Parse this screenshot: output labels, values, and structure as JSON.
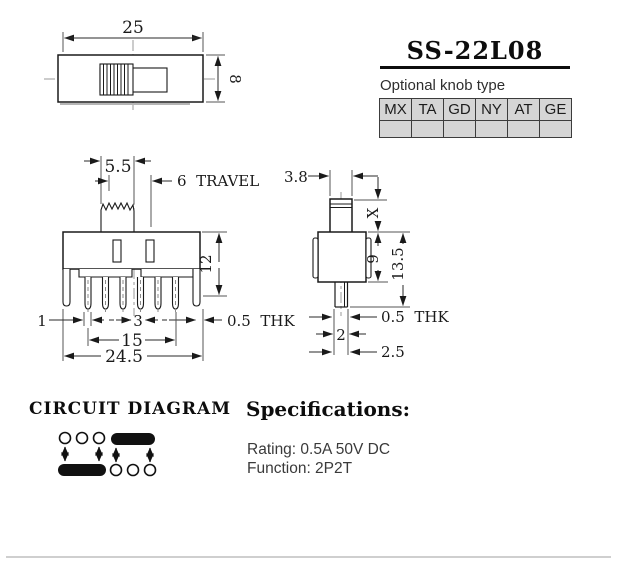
{
  "header": {
    "title": "SS-22L08",
    "knob_caption": "Optional knob type",
    "knob_types": [
      "MX",
      "TA",
      "GD",
      "NY",
      "AT",
      "GE"
    ]
  },
  "top_view": {
    "width": "25",
    "height": "8"
  },
  "front_view": {
    "knob_width": "5.5",
    "travel": "6  TRAVEL",
    "body_height": "12",
    "edge_offset": "1",
    "pin_pitch": "3",
    "thk": "0.5  THK",
    "pin_span": "15",
    "overall_width": "24.5"
  },
  "side_view": {
    "knob_width": "3.8",
    "knob_height": "X",
    "body_height": "9",
    "total_height": "13.5",
    "thk": "0.5  THK",
    "pin_width": "2",
    "pin_offset": "2.5"
  },
  "circuit": {
    "heading": "CIRCUIT DIAGRAM"
  },
  "specs": {
    "heading": "Specifications:",
    "rating": "Rating: 0.5A 50V DC",
    "function": "Function: 2P2T"
  }
}
